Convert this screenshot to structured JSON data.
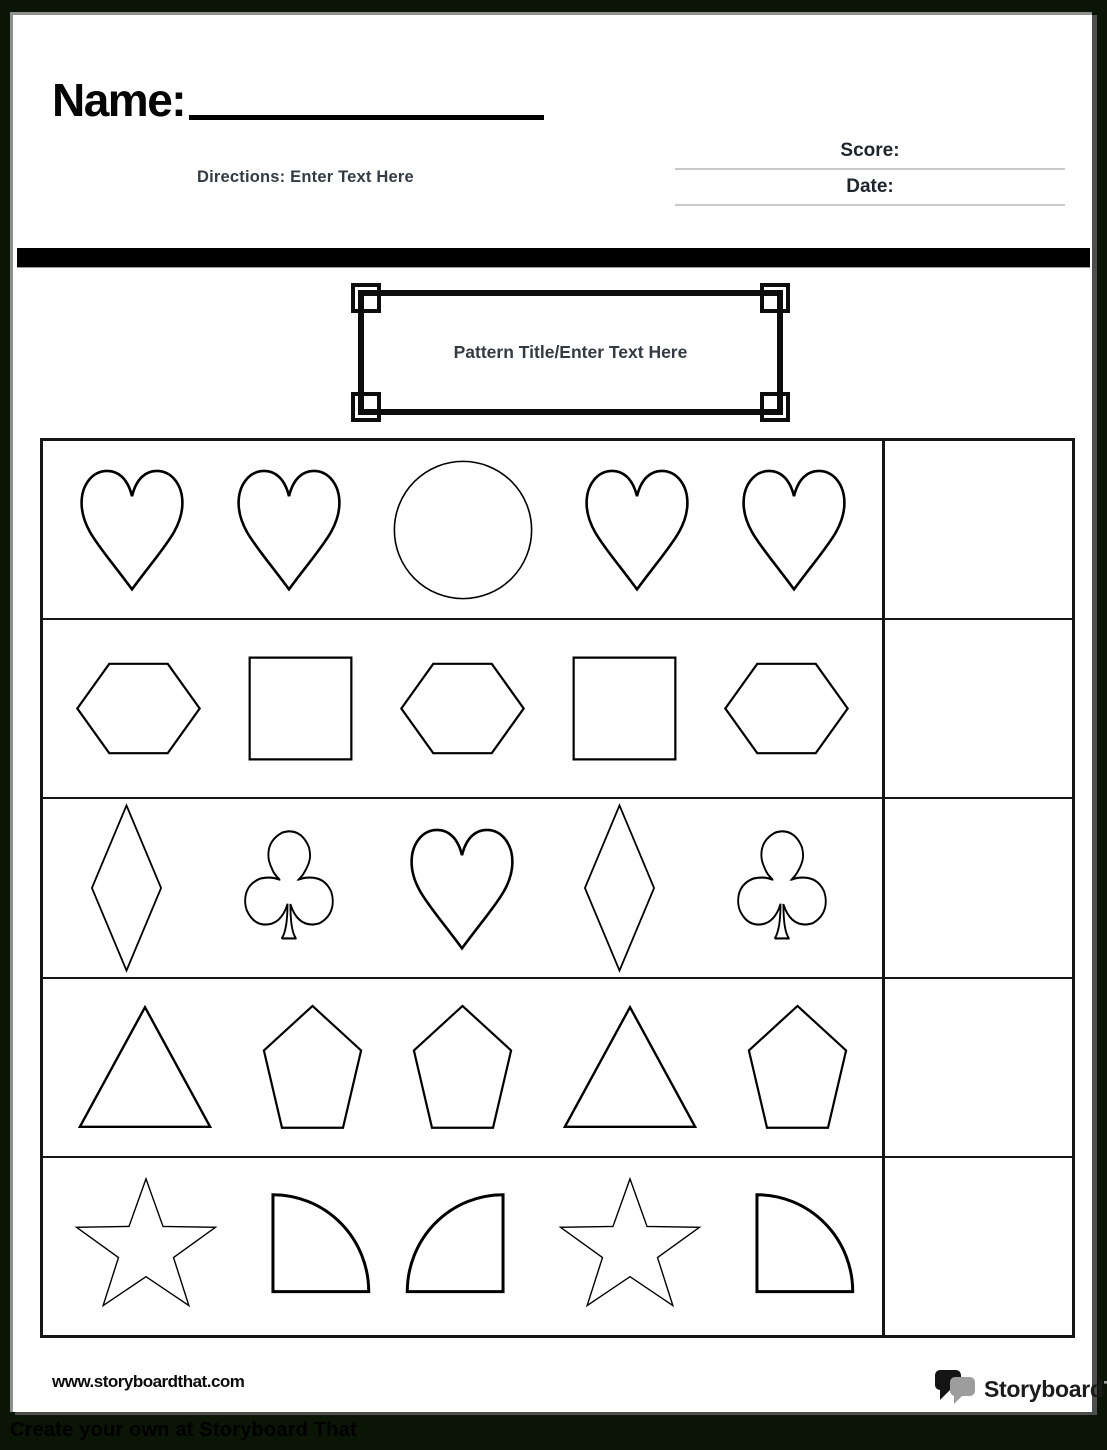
{
  "header": {
    "name_label": "Name:",
    "directions_label": "Directions: Enter Text Here",
    "score_label": "Score:",
    "date_label": "Date:"
  },
  "title_box": {
    "title": "Pattern Title/Enter Text Here"
  },
  "pattern_table": {
    "rows": [
      {
        "shapes": [
          "heart",
          "heart",
          "circle",
          "heart",
          "heart"
        ],
        "answer": ""
      },
      {
        "shapes": [
          "hexagon",
          "square",
          "hexagon",
          "square",
          "hexagon"
        ],
        "answer": ""
      },
      {
        "shapes": [
          "diamond",
          "club",
          "heart",
          "diamond",
          "club"
        ],
        "answer": ""
      },
      {
        "shapes": [
          "triangle",
          "pentagon",
          "pentagon",
          "triangle",
          "pentagon"
        ],
        "answer": ""
      },
      {
        "shapes": [
          "star",
          "quarter-circle-right",
          "quarter-circle-left",
          "star",
          "quarter-circle-right"
        ],
        "answer": ""
      }
    ]
  },
  "footer": {
    "website_url": "www.storyboardthat.com",
    "logo_text_primary": "Storyboard",
    "logo_text_secondary": "That"
  },
  "bottom_banner": {
    "text": "Create your own at Storyboard That"
  },
  "colors": {
    "ink": "#0d0d0d",
    "table_border": "#161616",
    "blank_line_gray": "#c9c9c9",
    "directions_text": "#333b44",
    "logo_gray": "#9d9d9d",
    "page_border_gray": "#8f8f8f",
    "page_shadow": "#4e4e4e",
    "surround_background": "#0a1505"
  }
}
